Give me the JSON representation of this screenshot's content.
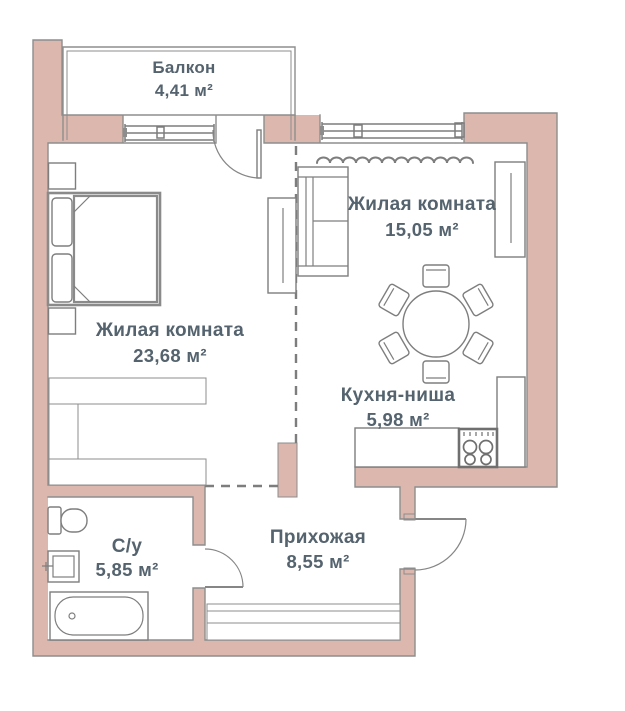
{
  "plan": {
    "title": "Однокомнатная квартира — план",
    "colors": {
      "wall": "#dbb7ae",
      "outline": "#8d8d8d",
      "furniture": "#7e7e7e",
      "label": "#54636e",
      "background": "#ffffff"
    },
    "rooms": [
      {
        "key": "balcony",
        "name": "Балкон",
        "area": "4,41 м²",
        "furniture": [
          "railing"
        ]
      },
      {
        "key": "living-room-small",
        "name": "Жилая комната",
        "area": "15,05 м²",
        "furniture": [
          "sofa",
          "wardrobe",
          "radiator",
          "window"
        ]
      },
      {
        "key": "living-room-large",
        "name": "Жилая комната",
        "area": "23,68 м²",
        "furniture": [
          "bed",
          "nightstand",
          "nightstand",
          "tv-stand",
          "wardrobe",
          "window",
          "balcony-door"
        ]
      },
      {
        "key": "kitchen-niche",
        "name": "Кухня-ниша",
        "area": "5,98 м²",
        "furniture": [
          "dining-table",
          "six-chairs",
          "counter",
          "stove",
          "tall-unit"
        ]
      },
      {
        "key": "bathroom",
        "name": "С/у",
        "area": "5,85 м²",
        "furniture": [
          "toilet",
          "sink",
          "bathtub",
          "door"
        ]
      },
      {
        "key": "hallway",
        "name": "Прихожая",
        "area": "8,55 м²",
        "furniture": [
          "wardrobe",
          "entrance-door"
        ]
      }
    ]
  }
}
